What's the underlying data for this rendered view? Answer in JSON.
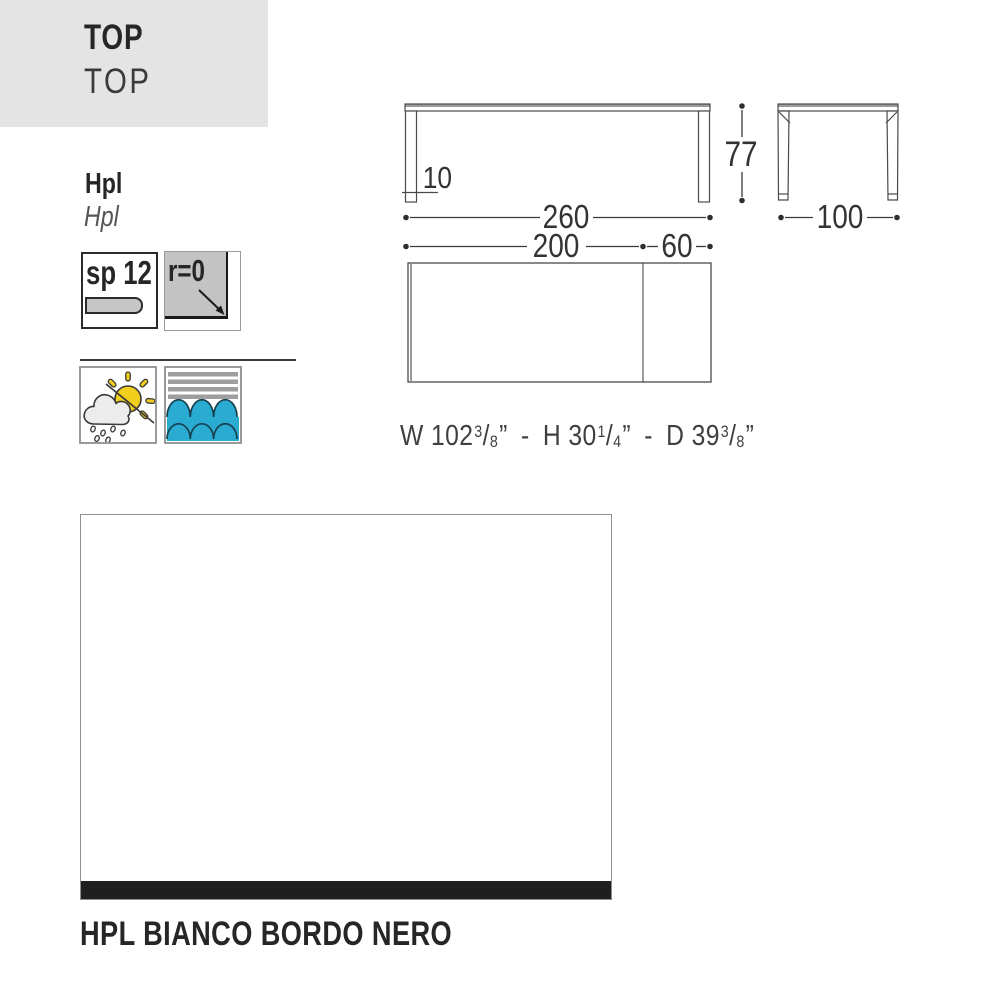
{
  "header": {
    "title_bold": "TOP",
    "title_light": "TOP"
  },
  "material": {
    "name_bold": "Hpl",
    "name_italic": "Hpl"
  },
  "spec_icons": {
    "thickness_label": "sp 12",
    "thickness_icon": "plank-icon",
    "radius_label": "r=0",
    "radius_icon": "corner-arrow-icon"
  },
  "feature_icons": {
    "outdoor_icon": "sun-cloud-rain-icon",
    "marine_icon": "waves-icon"
  },
  "drawing": {
    "front": {
      "width": "260",
      "leg_width": "10",
      "top_width": "200",
      "extension_width": "60"
    },
    "side": {
      "height": "77",
      "depth": "100"
    }
  },
  "imperial": {
    "w_label": "W 102",
    "w_num": "3",
    "w_den": "8",
    "h_label": "H 30",
    "h_num": "1",
    "h_den": "4",
    "d_label": "D 39",
    "d_num": "3",
    "d_den": "8",
    "inch": "”",
    "slash": "/",
    "sep": "-"
  },
  "swatch": {
    "caption": "HPL BIANCO BORDO NERO",
    "surface_color": "#ffffff",
    "edge_color": "#1f1f1f"
  },
  "colors": {
    "panel_gray": "#e4e4e4",
    "sun_yellow": "#f2cf1d",
    "water_blue": "#2aabd2",
    "stripe_gray": "#9e9e9e"
  }
}
